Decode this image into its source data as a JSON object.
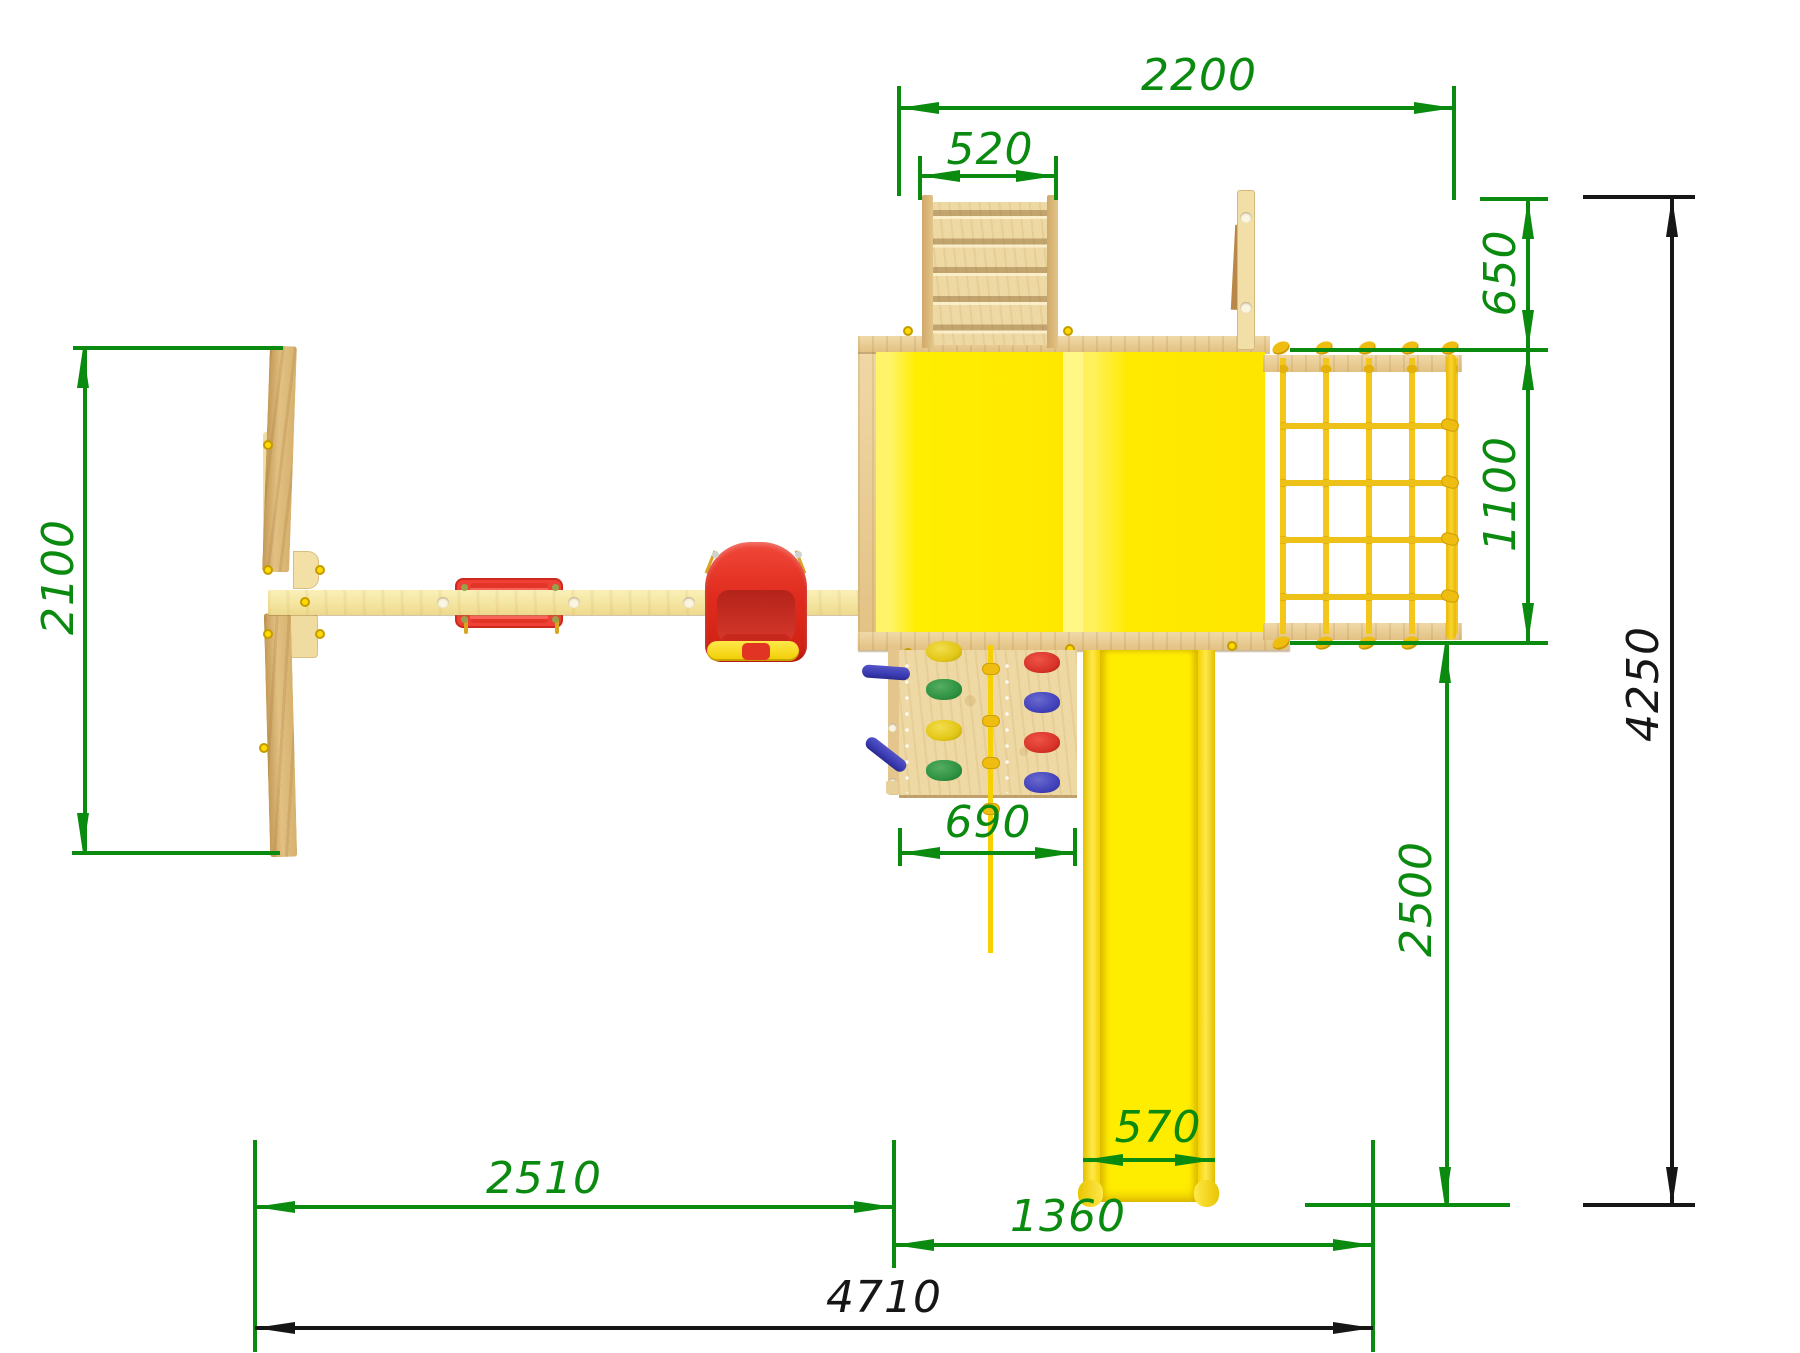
{
  "drawing": {
    "title": "playground-set-top-view-plan",
    "unit_system": "mm",
    "colors": {
      "dim_green": "#0a8a0f",
      "dim_black": "#161616",
      "roof_yellow": "#ffea00",
      "slide_yellow": "#ffe900",
      "rope_yellow": "#f2c41c",
      "wood_light": "#f6ecae",
      "wood_mid": "#e7cd9a",
      "seat_red": "#e63527"
    },
    "dims": {
      "w2200": "2200",
      "w520": "520",
      "h650": "650",
      "h1100": "1100",
      "h4250": "4250",
      "h2100": "2100",
      "w690": "690",
      "h2500": "2500",
      "w570": "570",
      "w2510": "2510",
      "w1360": "1360",
      "w4710": "4710"
    }
  }
}
